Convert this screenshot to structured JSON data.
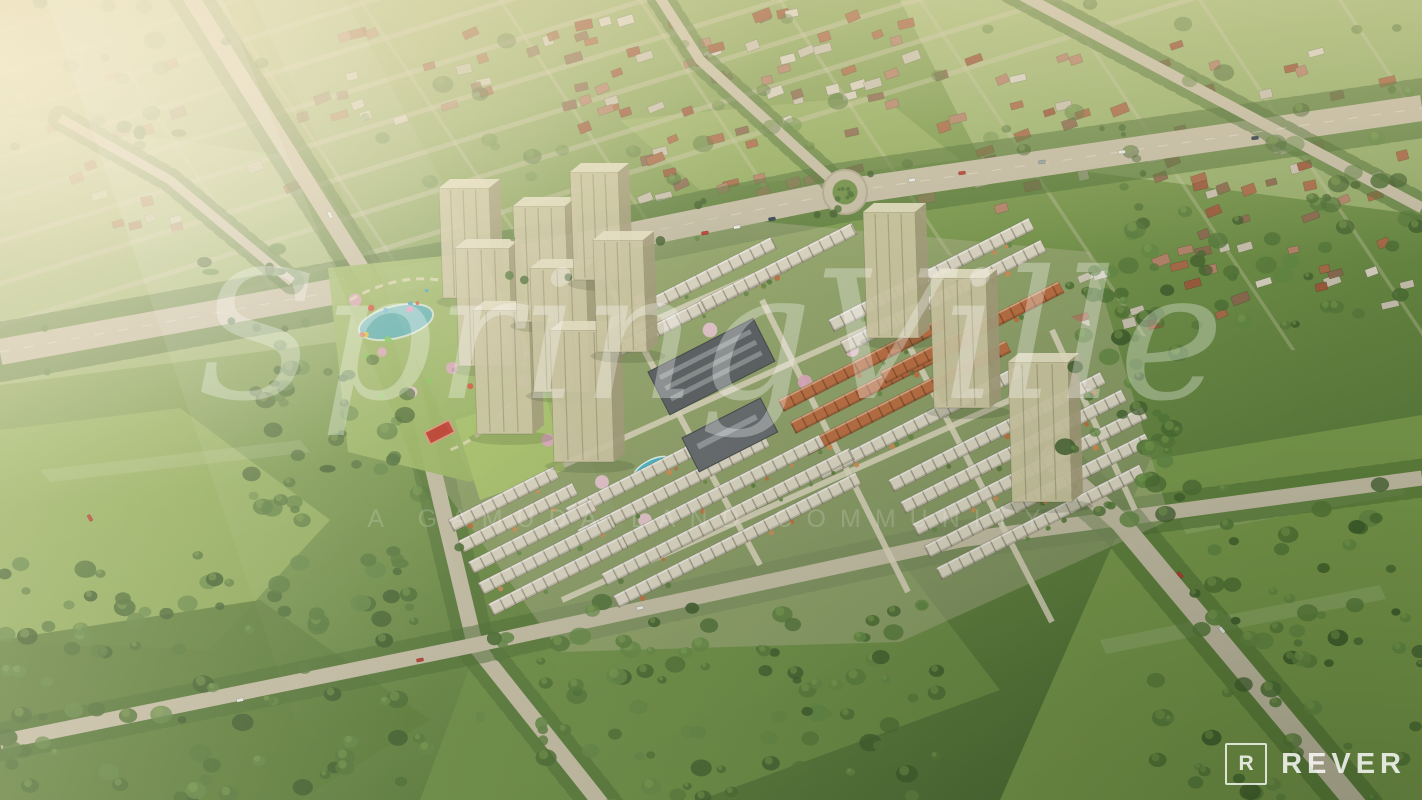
{
  "watermark": {
    "title": "SpringVille",
    "tagline": "A GAMUDA LAND COMMUNITY"
  },
  "logo": {
    "initial": "R",
    "name": "REVER"
  },
  "palette": {
    "bgTop": "#b4c286",
    "bgBottom": "#4e6f35",
    "grass": "#7c9c4e",
    "grassLight": "#9cb863",
    "grassPale": "#c2cf94",
    "grassDeep": "#5d7e3a",
    "forest1": "#3e5d2c",
    "forest2": "#4a6d33",
    "forest3": "#55793a",
    "forest4": "#628844",
    "canopyHi": "#83a452",
    "road": "#c7bfa8",
    "roadLight": "#ddd6bf",
    "river": "#4a9aa0",
    "riverDeep": "#2e7d88",
    "riverHi": "#9fd4d2",
    "towerFace": "#cfc8a4",
    "towerSide": "#a39b79",
    "towerTop": "#e8e2c6",
    "roofWhite": "#ddd7c6",
    "roofTerracotta": "#b96a3e",
    "suburbRoof": "#a96a48",
    "blossom": "#dca8bd",
    "blossomLight": "#e9c5d3",
    "clubRoof": "#565b60",
    "clubRoofHi": "#8a9094",
    "pool": "#45b6c8",
    "court": "#c0392b",
    "carRed": "#c0392b",
    "carWhite": "#edf0ea",
    "carDark": "#2c3e50",
    "sunHaze": "#f8efd8",
    "watermarkColor": "#ffffff"
  }
}
